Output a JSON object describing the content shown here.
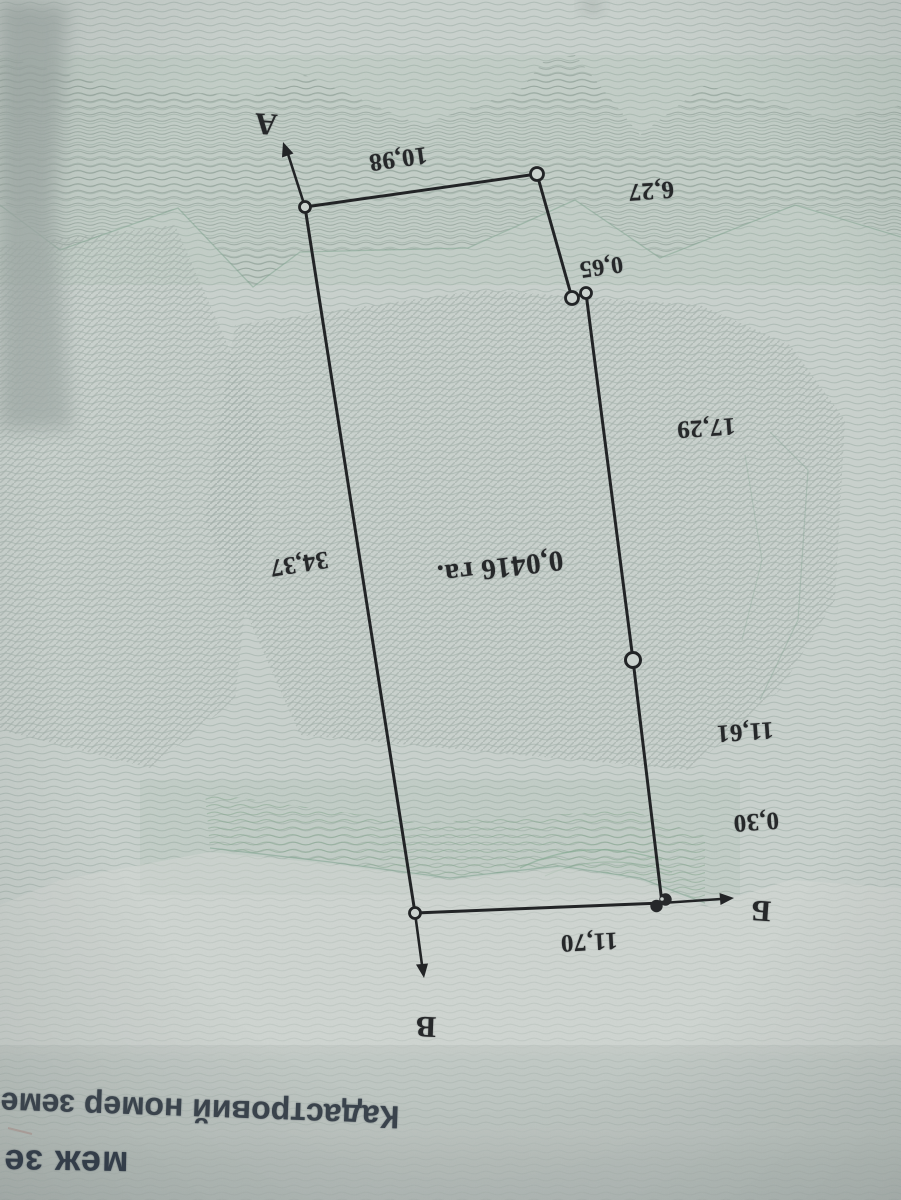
{
  "plan": {
    "area_label": "0,0416 га.",
    "vertex_labels": {
      "a": "А",
      "b": "Б",
      "v": "В"
    },
    "dimensions": {
      "top": "10,98",
      "upper_right": "6,27",
      "upper_right_small": "0,65",
      "right_upper": "17,29",
      "right_lower": "11,61",
      "corner_small": "0,30",
      "bottom": "11,70",
      "left": "34,37"
    }
  },
  "footer": {
    "cadastral_number_label": "Кадастровий номер земе",
    "boundaries_label": "меж зе"
  },
  "colors": {
    "paper": "#c9d1cd",
    "guilloche_pattern": "#9caca5",
    "guilloche_green": "#8aa893",
    "ink": "#222426",
    "footer_ink": "#3a434c"
  }
}
